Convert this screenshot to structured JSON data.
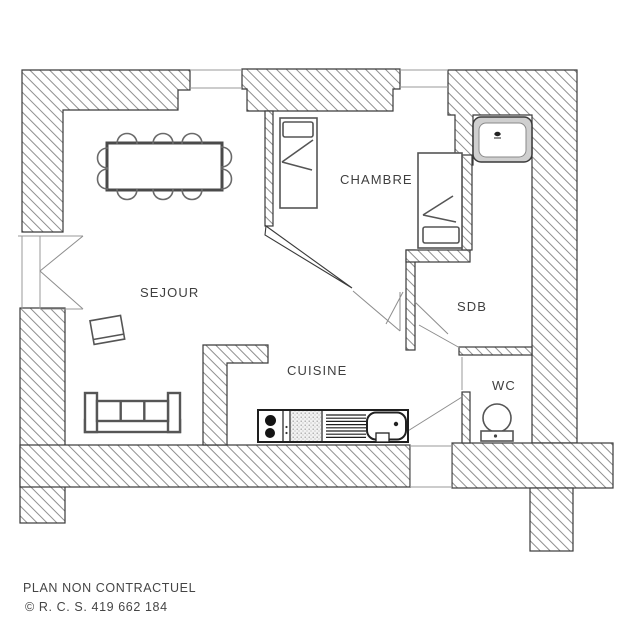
{
  "plan": {
    "rooms": {
      "sejour": {
        "label": "SEJOUR"
      },
      "chambre": {
        "label": "CHAMBRE"
      },
      "cuisine": {
        "label": "CUISINE"
      },
      "sdb": {
        "label": "SDB"
      },
      "wc": {
        "label": "WC"
      }
    },
    "footer": {
      "disclaimer": "PLAN NON CONTRACTUEL",
      "registration": "© R. C. S. 419 662 184"
    },
    "furniture_icons": [
      "dining-table-icon",
      "chair-icon",
      "sofa-icon",
      "side-table-icon",
      "single-bed-icon",
      "single-bed-icon",
      "shower-tray-icon",
      "toilet-icon",
      "kitchen-counter-icon",
      "hob-burners-icon",
      "sink-icon"
    ]
  },
  "colors": {
    "background": "#ffffff",
    "wall_line": "#3a3a3a",
    "hatch_line": "#8f8f8f",
    "thin_line": "#9a9a9a",
    "furniture_line": "#555555",
    "text": "#3f3f3f"
  }
}
